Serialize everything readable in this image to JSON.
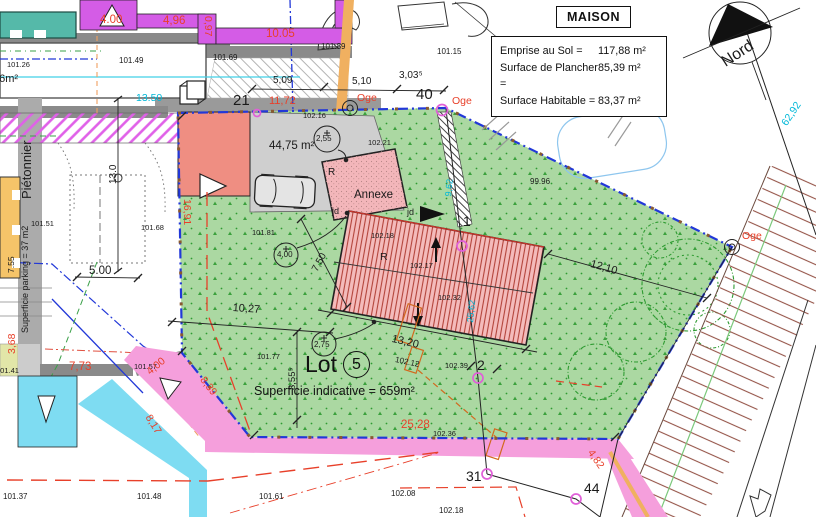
{
  "legend": {
    "title": "MAISON",
    "rows": [
      {
        "label": "Emprise au Sol =",
        "value": "117,88 m²"
      },
      {
        "label": "Surface de Plancher =",
        "value": "85,39 m²"
      },
      {
        "label": "Surface Habitable =",
        "value": "83,37 m²"
      }
    ]
  },
  "lot": {
    "word": "Lot",
    "number": "5",
    "area_note": "Superficie indicative = 659m²"
  },
  "palette": {
    "dimension_red": "#e8402a",
    "survey_cyan": "#00b8d8",
    "boundary_blue": "#2238d8",
    "lot_green": "#abd8a2",
    "house_pink": "#f4bbbb",
    "parking_salmon": "#ef8e82",
    "path_magenta": "#d45ce6",
    "path_pink": "#f59fdc",
    "path_cyan": "#7edcf2",
    "marker_magenta": "#e060d8",
    "talus_brown": "#96564a"
  },
  "labels": [
    {
      "name": "area-36m2-partial",
      "text": "36m²",
      "x": -7,
      "y": 74,
      "size": 11
    },
    {
      "name": "level-101-26",
      "text": "101.26",
      "x": 7,
      "y": 61,
      "size": 7.5
    },
    {
      "name": "level-101-49",
      "text": "101.49",
      "x": 119,
      "y": 57,
      "size": 8
    },
    {
      "name": "level-101-69",
      "text": "101.69",
      "x": 213,
      "y": 54,
      "size": 8
    },
    {
      "name": "level-101-89",
      "text": "101.89",
      "x": 321,
      "y": 43,
      "size": 8
    },
    {
      "name": "level-101-15",
      "text": "101.15",
      "x": 437,
      "y": 48,
      "size": 8
    },
    {
      "name": "level-100-00",
      "text": "100.00",
      "x": 577,
      "y": 89,
      "size": 8
    },
    {
      "name": "level-99-96",
      "text": "99.96",
      "x": 530,
      "y": 178,
      "size": 8
    },
    {
      "name": "dim-4-00-top",
      "text": "4.00",
      "x": 100,
      "y": 15,
      "size": 11.5,
      "color": "#e8402a"
    },
    {
      "name": "dim-4-96",
      "text": "4,96",
      "x": 163,
      "y": 16,
      "size": 11.5,
      "color": "#e8402a"
    },
    {
      "name": "dim-0-97",
      "text": "0,97",
      "x": 213,
      "y": 16,
      "size": 10.5,
      "color": "#e8402a",
      "rot": 90
    },
    {
      "name": "dim-10-05",
      "text": "10.05",
      "x": 266,
      "y": 29,
      "size": 11.5,
      "color": "#e8402a"
    },
    {
      "name": "dim-13-50",
      "text": "13.50",
      "x": 136,
      "y": 93,
      "size": 10.5,
      "color": "#00b8d8"
    },
    {
      "name": "parcel-21",
      "text": "21",
      "x": 233,
      "y": 93,
      "size": 15
    },
    {
      "name": "dim-11-72",
      "text": "11,72",
      "x": 269,
      "y": 96,
      "size": 11,
      "color": "#e8402a"
    },
    {
      "name": "dim-5-09",
      "text": "5,09",
      "x": 273,
      "y": 76,
      "size": 10
    },
    {
      "name": "dim-5-10",
      "text": "5,10",
      "x": 352,
      "y": 77,
      "size": 10
    },
    {
      "name": "dim-3-03-5",
      "text": "3,03⁵",
      "x": 399,
      "y": 71,
      "size": 10
    },
    {
      "name": "point-40",
      "text": "40",
      "x": 416,
      "y": 87,
      "size": 15
    },
    {
      "name": "oge-label-1",
      "text": "Oge",
      "x": 357,
      "y": 93,
      "size": 10.5,
      "color": "#e8402a"
    },
    {
      "name": "oge-label-2",
      "text": "Oge",
      "x": 452,
      "y": 96,
      "size": 10.5,
      "color": "#e8402a"
    },
    {
      "name": "oge-label-3",
      "text": "Oge",
      "x": 742,
      "y": 231,
      "size": 10.5,
      "color": "#e8402a"
    },
    {
      "name": "level-102-16",
      "text": "102.16",
      "x": 303,
      "y": 112,
      "size": 7.5
    },
    {
      "name": "spot-2-55",
      "text": "2,55",
      "x": 316,
      "y": 135,
      "size": 8
    },
    {
      "name": "area-44-75",
      "text": "44,75 m²",
      "x": 269,
      "y": 141,
      "size": 11.5
    },
    {
      "name": "level-102-21",
      "text": "102.21",
      "x": 368,
      "y": 139,
      "size": 7.5
    },
    {
      "name": "annexe-label",
      "text": "Annexe",
      "x": 354,
      "y": 190,
      "size": 11.5
    },
    {
      "name": "annexe-r",
      "text": "R",
      "x": 328,
      "y": 168,
      "size": 10
    },
    {
      "name": "jd-label-1",
      "text": "jd",
      "x": 332,
      "y": 207,
      "size": 9
    },
    {
      "name": "jd-label-2",
      "text": "jd",
      "x": 407,
      "y": 208,
      "size": 9
    },
    {
      "name": "house-r",
      "text": "R",
      "x": 380,
      "y": 252,
      "size": 10.5
    },
    {
      "name": "level-102-18",
      "text": "102.18",
      "x": 371,
      "y": 232,
      "size": 7.5
    },
    {
      "name": "level-102-17",
      "text": "102.17",
      "x": 410,
      "y": 262,
      "size": 7.5
    },
    {
      "name": "level-102-32",
      "text": "102.32",
      "x": 438,
      "y": 294,
      "size": 7.5
    },
    {
      "name": "point-1",
      "text": "1",
      "x": 463,
      "y": 214,
      "size": 14
    },
    {
      "name": "dim-9-62",
      "text": "9,62",
      "x": 444,
      "y": 196,
      "size": 9,
      "color": "#00b8d8",
      "rot": -84
    },
    {
      "name": "dim-25-62",
      "text": "25,62",
      "x": 466,
      "y": 322,
      "size": 9,
      "color": "#00b8d8",
      "rot": -84
    },
    {
      "name": "dim-16-91",
      "text": "16,91",
      "x": 192,
      "y": 199,
      "size": 10.5,
      "color": "#e8402a",
      "rot": 90
    },
    {
      "name": "level-101-81",
      "text": "101.81",
      "x": 252,
      "y": 229,
      "size": 7.5
    },
    {
      "name": "spot-4-00",
      "text": "4,00",
      "x": 277,
      "y": 251,
      "size": 8
    },
    {
      "name": "dim-7-50",
      "text": "7,50",
      "x": 311,
      "y": 269,
      "size": 10,
      "rot": -62
    },
    {
      "name": "level-101-68",
      "text": "101.68",
      "x": 141,
      "y": 224,
      "size": 7.5
    },
    {
      "name": "level-101-51",
      "text": "101.51",
      "x": 31,
      "y": 220,
      "size": 7.5
    },
    {
      "name": "dim-7-55",
      "text": "7.55",
      "x": 7,
      "y": 273,
      "size": 8.5,
      "rot": -90
    },
    {
      "name": "dim-5-00",
      "text": "5.00",
      "x": 89,
      "y": 266,
      "size": 11.5
    },
    {
      "name": "dim-13-0",
      "text": "13.0",
      "x": 109,
      "y": 184,
      "size": 10,
      "rot": -90
    },
    {
      "name": "pietonnier-label",
      "text": "Piétonnier",
      "x": 20,
      "y": 199,
      "size": 13,
      "rot": -90
    },
    {
      "name": "parking-strip-label",
      "text": "Superficie parking = 37 m2",
      "x": 21,
      "y": 333,
      "size": 9,
      "rot": -90
    },
    {
      "name": "level-101-41",
      "text": "101.41",
      "x": -4,
      "y": 367,
      "size": 7.5
    },
    {
      "name": "dim-3-68",
      "text": "3,68",
      "x": 7,
      "y": 354,
      "size": 10.5,
      "color": "#e8402a",
      "rot": -90
    },
    {
      "name": "dim-7-73",
      "text": "7,73",
      "x": 69,
      "y": 362,
      "size": 11.5,
      "color": "#e8402a"
    },
    {
      "name": "level-101-57",
      "text": "101.57",
      "x": 134,
      "y": 363,
      "size": 7.5
    },
    {
      "name": "dim-4-00-path",
      "text": "4,00",
      "x": 145,
      "y": 369,
      "size": 10.5,
      "color": "#e8402a",
      "rot": -40
    },
    {
      "name": "dim-8-39",
      "text": "8,39",
      "x": 206,
      "y": 375,
      "size": 10.5,
      "color": "#e8402a",
      "rot": 52
    },
    {
      "name": "dim-8-17",
      "text": "8,17",
      "x": 152,
      "y": 413,
      "size": 10.5,
      "color": "#e8402a",
      "rot": 58
    },
    {
      "name": "level-101-37",
      "text": "101.37",
      "x": 3,
      "y": 493,
      "size": 8
    },
    {
      "name": "level-101-48",
      "text": "101.48",
      "x": 137,
      "y": 493,
      "size": 8
    },
    {
      "name": "level-101-61",
      "text": "101.61",
      "x": 259,
      "y": 493,
      "size": 8
    },
    {
      "name": "level-102-08",
      "text": "102.08",
      "x": 391,
      "y": 490,
      "size": 8
    },
    {
      "name": "level-102-18-b",
      "text": "102.18",
      "x": 439,
      "y": 507,
      "size": 8
    },
    {
      "name": "level-101-77",
      "text": "101.77",
      "x": 257,
      "y": 353,
      "size": 7.5
    },
    {
      "name": "dim-10-27",
      "text": "10,27",
      "x": 233,
      "y": 303,
      "size": 11,
      "rot": 4
    },
    {
      "name": "spot-2-75",
      "text": "2,75",
      "x": 314,
      "y": 341,
      "size": 8
    },
    {
      "name": "dim-8-55-5",
      "text": "8,55⁵",
      "x": 288,
      "y": 390,
      "size": 9.5,
      "rot": -90
    },
    {
      "name": "dim-13-20",
      "text": "13,20",
      "x": 393,
      "y": 334,
      "size": 11,
      "rot": 13
    },
    {
      "name": "level-102-12",
      "text": "102.12",
      "x": 396,
      "y": 356,
      "size": 8,
      "rot": 12
    },
    {
      "name": "level-102-39",
      "text": "102.39",
      "x": 445,
      "y": 362,
      "size": 7.5
    },
    {
      "name": "point-2",
      "text": "2",
      "x": 477,
      "y": 358,
      "size": 14
    },
    {
      "name": "dim-25-28",
      "text": "25,28",
      "x": 401,
      "y": 420,
      "size": 11.5,
      "color": "#e8402a"
    },
    {
      "name": "level-102-36",
      "text": "102.36",
      "x": 433,
      "y": 430,
      "size": 7.5
    },
    {
      "name": "point-31",
      "text": "31",
      "x": 466,
      "y": 469,
      "size": 14
    },
    {
      "name": "point-44",
      "text": "44",
      "x": 584,
      "y": 481,
      "size": 14
    },
    {
      "name": "dim-4-82",
      "text": "4,82",
      "x": 594,
      "y": 448,
      "size": 10.5,
      "color": "#e8402a",
      "rot": 55
    },
    {
      "name": "dim-12-10",
      "text": "12,10",
      "x": 592,
      "y": 259,
      "size": 11,
      "rot": 16
    },
    {
      "name": "dim-62-92",
      "text": "62,92",
      "x": 780,
      "y": 122,
      "size": 10.5,
      "color": "#00b8d8",
      "rot": -56
    },
    {
      "name": "nord-label",
      "text": "Nord",
      "x": 719,
      "y": 57,
      "size": 16,
      "rot": -33
    }
  ]
}
